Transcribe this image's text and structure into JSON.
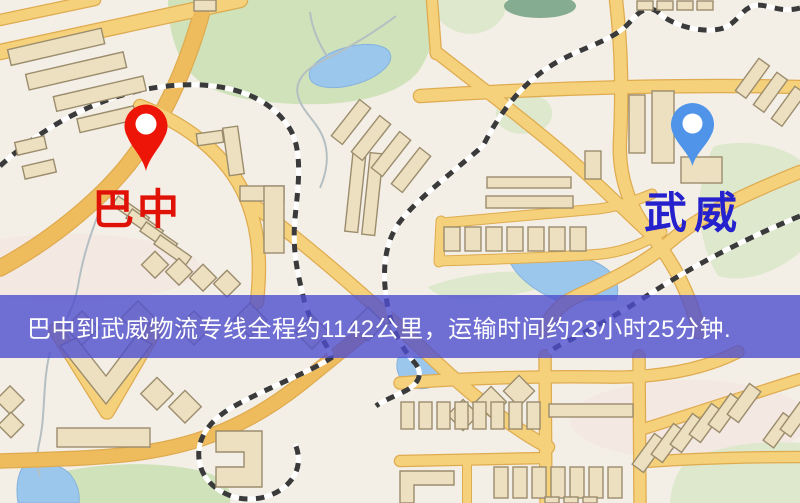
{
  "route": {
    "origin": {
      "label": "巴中",
      "marker_color": "#ed1507",
      "label_color": "#e01208"
    },
    "destination": {
      "label": "武威",
      "marker_color": "#4f94e9",
      "label_color": "#2421cd"
    },
    "distance_km": "1142",
    "duration": "23小时25分钟"
  },
  "banner": {
    "text": "巴中到武威物流专线全程约1142公里，运输时间约23小时25分钟.",
    "background": "#4d4ecd",
    "text_color": "#ffffff"
  },
  "map": {
    "colors": {
      "background": "#f4efe6",
      "road": "#f4d17a",
      "road_major": "#eebb5d",
      "road_casing": "#dfab50",
      "building": "#ece0c0",
      "building_outline": "#9b8c6d",
      "park": "#cfe2ba",
      "water": "#9cc7ec",
      "railway": "#3a3a3a"
    }
  }
}
